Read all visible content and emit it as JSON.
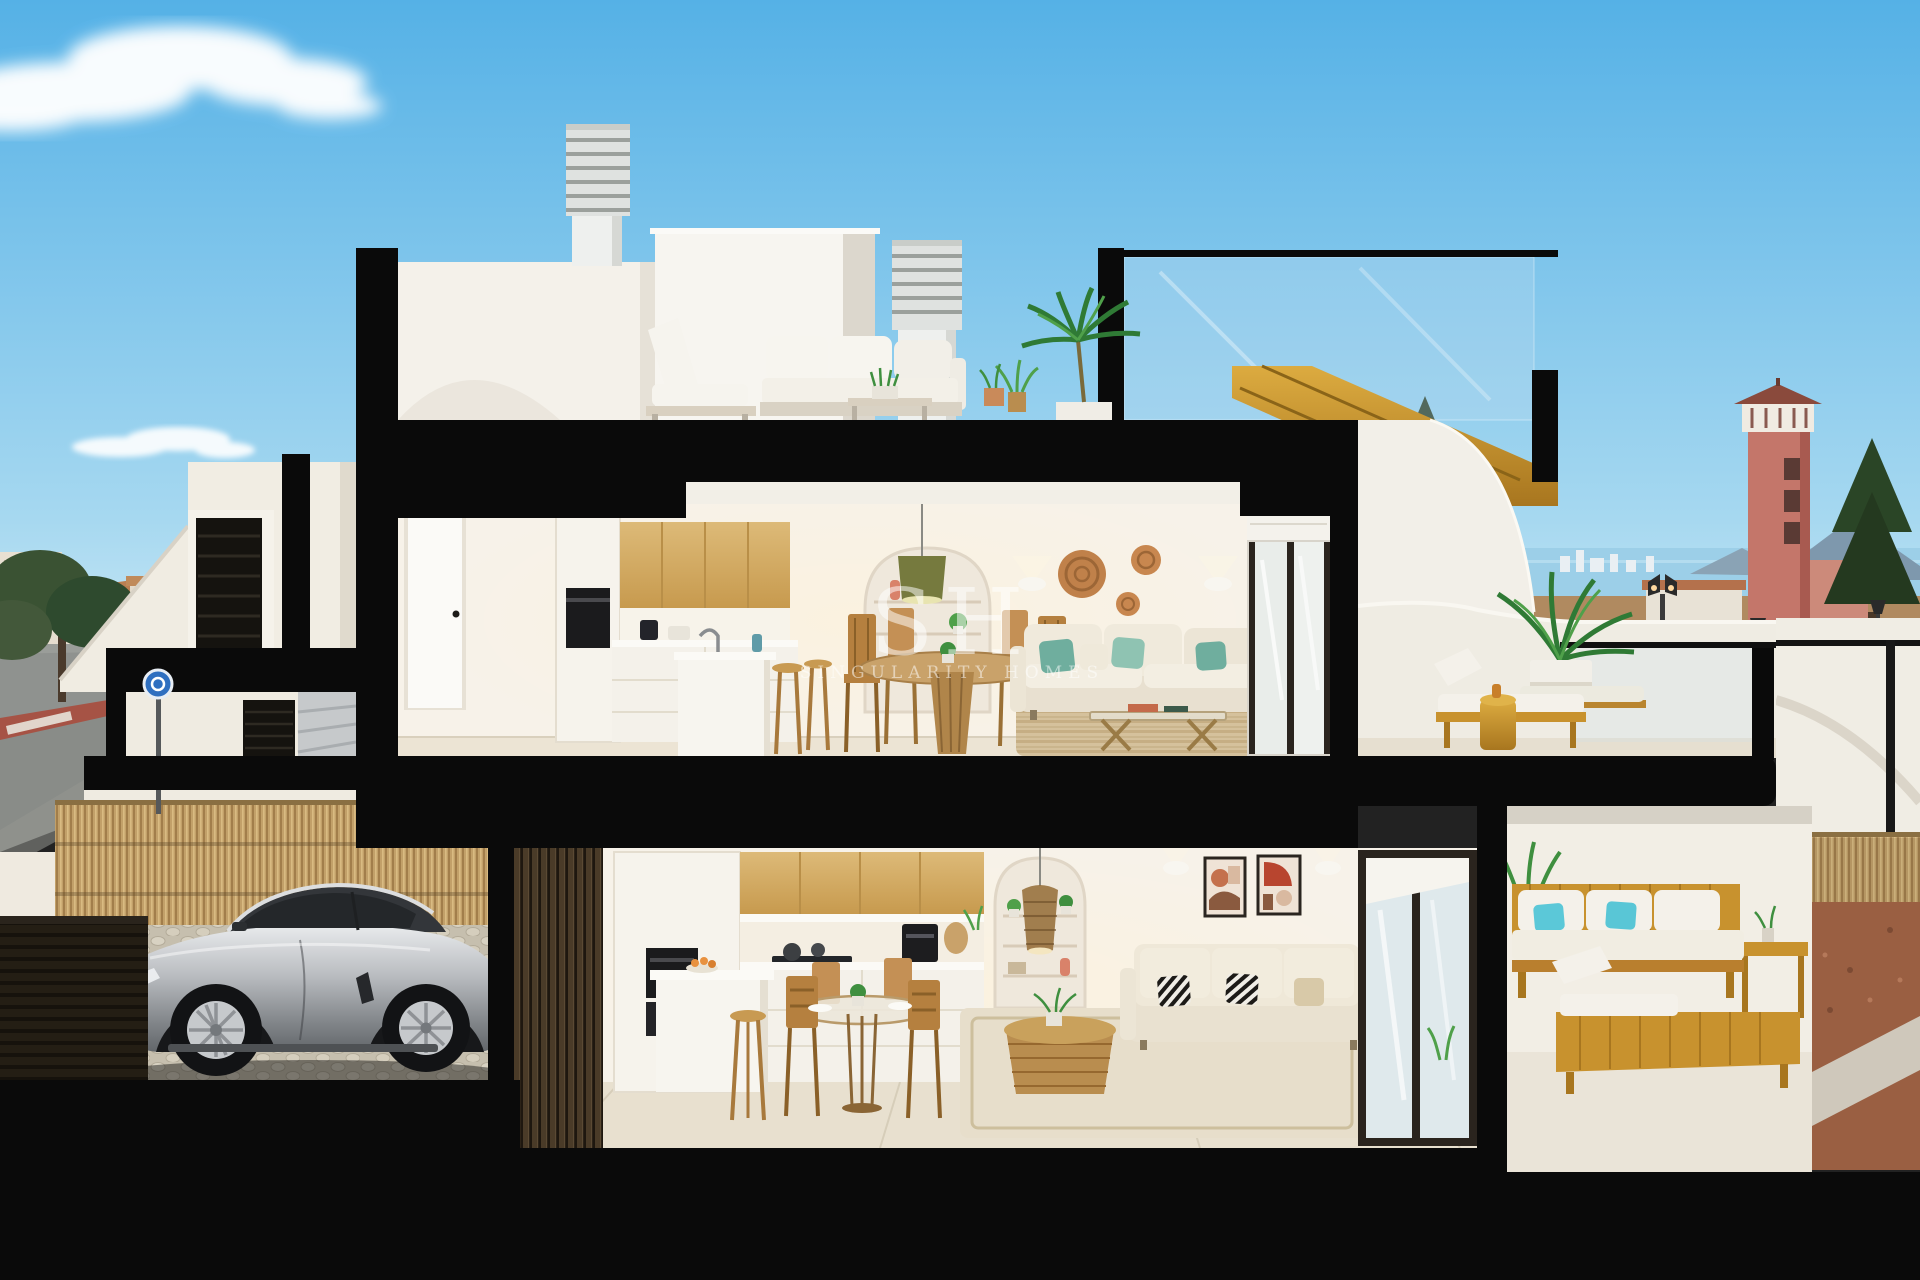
{
  "watermark": {
    "initials": "SH",
    "name": "SINGULARITY HOMES"
  },
  "palette": {
    "sky-top": "#55b1e6",
    "sky-mid": "#a6d8f0",
    "sky-horizon": "#d8eef8",
    "section-black": "#0a0a0a",
    "wall-white": "#f3f0e9",
    "wall-shade": "#ddd8cd",
    "interior-wall": "#f7f2e9",
    "wood-cabinet": "#d3aa66",
    "wood-gold": "#c8922e",
    "wood-furniture": "#b5803f",
    "floor-tile": "#e9e1d2",
    "teal-pillow": "#6fae9e",
    "cyan-pillow": "#5bc8d8",
    "rattan": "#c0814a",
    "terracotta-tower": "#c4766a",
    "car-silver": "#b9bcc0",
    "bamboo": "#c2a069",
    "sea": "#9ccfe8",
    "field-tan": "#b08a60",
    "street-gray": "#8f928f",
    "crosswalk-red": "#a65345",
    "tree-dark": "#2e4a2e",
    "plant-green": "#3f8f3f",
    "rug-jute": "#d2bd97",
    "gravel-rust": "#9a5f42",
    "watermark": "rgba(255,255,255,0.52)"
  }
}
